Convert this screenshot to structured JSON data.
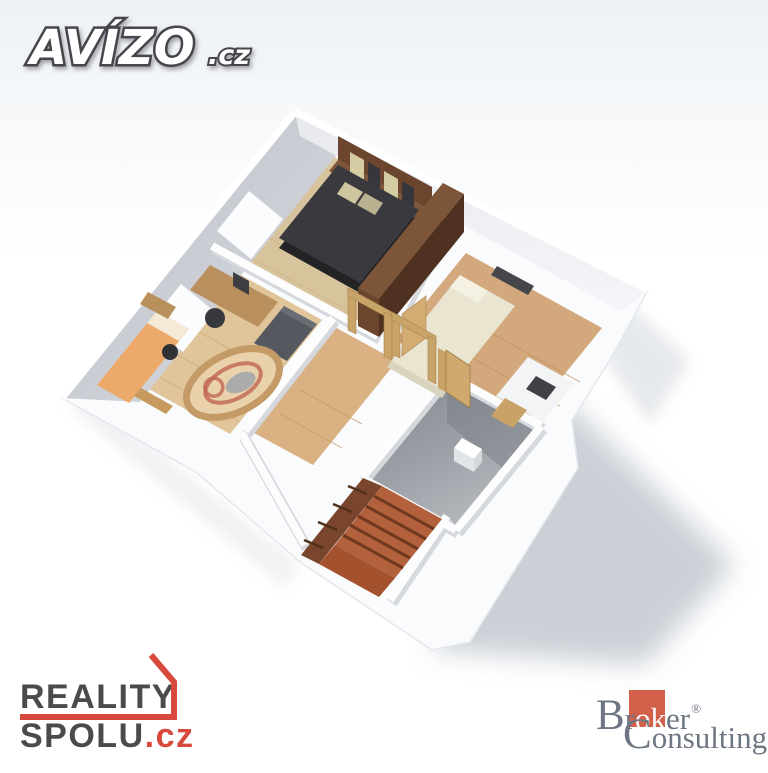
{
  "logos": {
    "avizo": {
      "brand": "AVÍZO",
      "tld": ".cz"
    },
    "reality_spolu": {
      "line1": "REALITY",
      "line2": "SPOLU",
      "tld": ".cz"
    },
    "broker": {
      "b": "B",
      "r": "r",
      "ok": "ok",
      "er": "er",
      "reg": "®",
      "c": "C",
      "rest": "onsulting"
    }
  },
  "palette": {
    "brand_red": "#d6493c",
    "broker_square": "#d2604a",
    "broker_text": "#6e7683",
    "dark_text": "#4a4b4d",
    "wall_shade": "#c9ccd2",
    "wood_light": "#d8c49c",
    "wood_mid": "#d2a87c",
    "terracotta_stairs": "#b2613c",
    "bathroom_gray": "#989ea4",
    "cast_shadow": "#b6bdc6"
  },
  "scene": {
    "description": "3D dollhouse-style rendering of an upper floor plan",
    "rooms": [
      {
        "name": "master bedroom",
        "furniture": [
          "double bed",
          "headboard with pillows",
          "wardrobe",
          "window"
        ]
      },
      {
        "name": "second bedroom",
        "furniture": [
          "single bed",
          "wall shelf",
          "white desk",
          "chair"
        ]
      },
      {
        "name": "study room",
        "furniture": [
          "desk with monitor",
          "office chair",
          "tv cabinet",
          "oval rug",
          "bed",
          "dresser",
          "window"
        ]
      },
      {
        "name": "hallway",
        "furniture": [
          "open wooden door frames"
        ]
      },
      {
        "name": "bathroom",
        "furniture": [
          "toilet",
          "wooden door"
        ]
      },
      {
        "name": "staircase",
        "furniture": [
          "terracotta steps",
          "landing"
        ]
      }
    ]
  }
}
